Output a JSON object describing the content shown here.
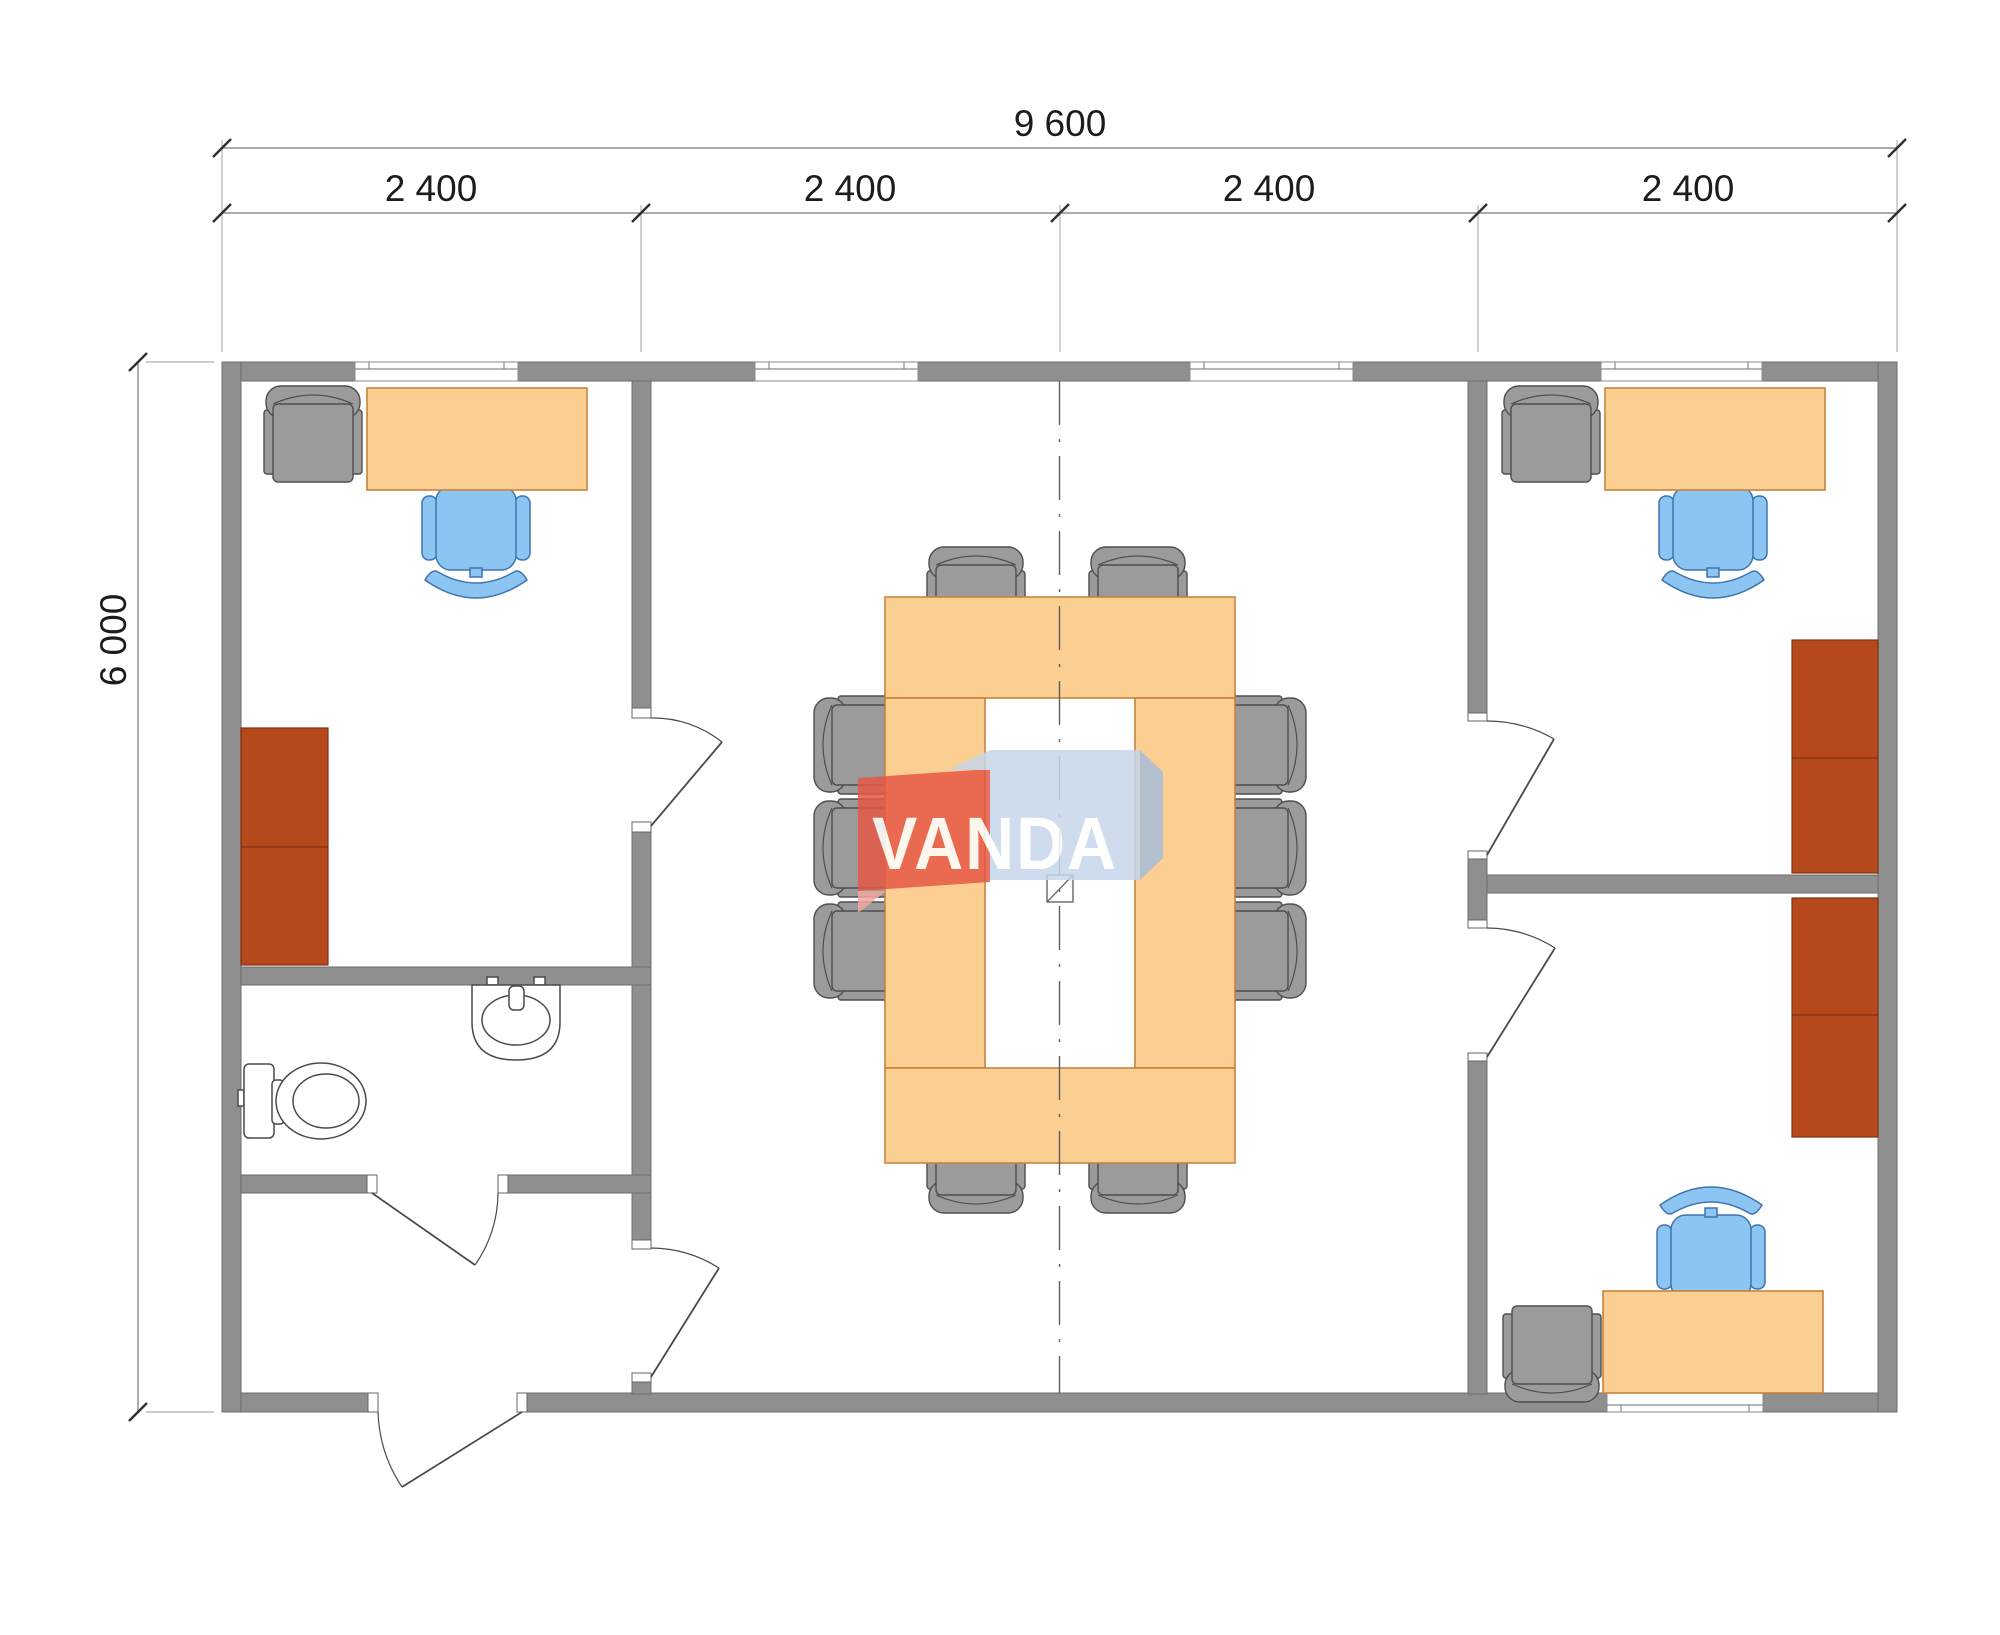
{
  "meta": {
    "drawing_type": "office-module-floor-plan"
  },
  "dimensions": {
    "overall_width": "9 600",
    "overall_height": "6 000",
    "modules": [
      "2 400",
      "2 400",
      "2 400",
      "2 400"
    ]
  },
  "watermark": {
    "text": "VANDA"
  },
  "colors": {
    "wall": "#8f8f8f",
    "desk": "#fbce92",
    "table": "#fbce92",
    "cabinet": "#b5491b",
    "chair_gray": "#9b9b9b",
    "chair_blue": "#8cc5f2",
    "watermark_red": "#e65946",
    "watermark_blue": "#c6d6ea"
  }
}
